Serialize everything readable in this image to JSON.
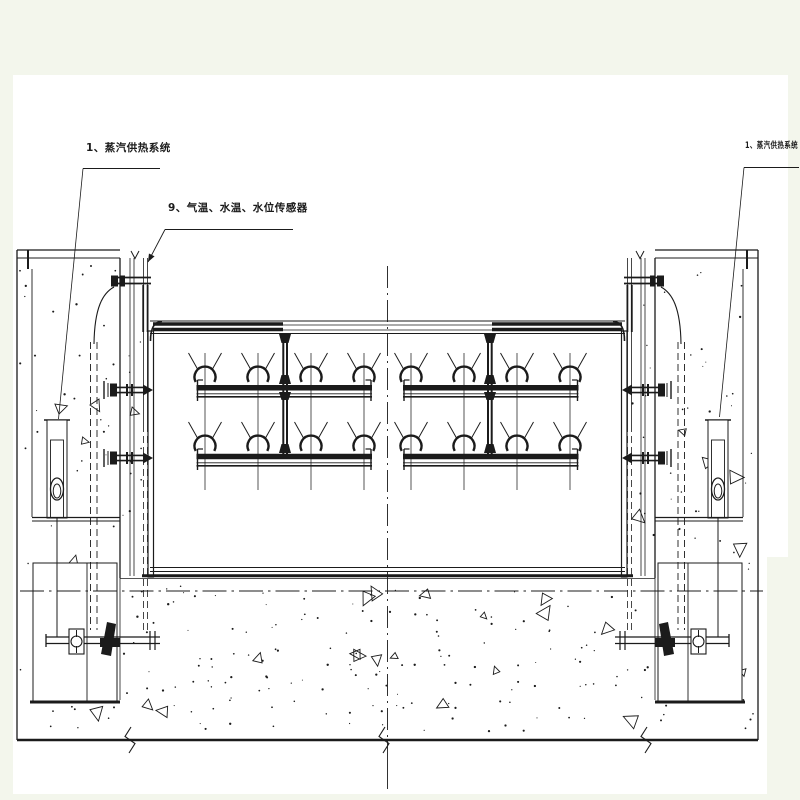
{
  "drawing": {
    "labels": {
      "left_system": "1、蒸汽供热系统",
      "sensors": "9、气温、水温、水位传感器",
      "right_system": "1、蒸汽供热系统"
    },
    "colors": {
      "line": "#1b1b1b",
      "paper": "#ffffff",
      "margin_band": "#f3f6ec"
    }
  }
}
